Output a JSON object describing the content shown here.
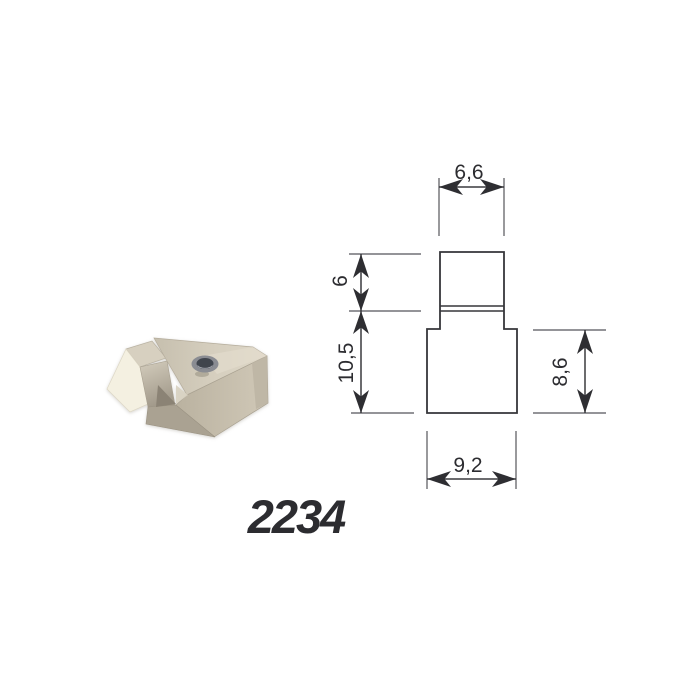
{
  "product": {
    "number": "2234"
  },
  "drawing": {
    "labels": {
      "top_width": "6,6",
      "upper_height": "6",
      "total_height": "10,5",
      "side_height": "8,6",
      "bottom_width": "9,2"
    },
    "line_color": "#3a3a3e",
    "label_color": "#2c2c30"
  },
  "part": {
    "colors": {
      "top_face": "#d3ccbb",
      "front_face": "#c7bfae",
      "end_face": "#bcb4a3",
      "chamfer_face": "#b9b1a1",
      "foot_face": "#aaa292",
      "notch_shadow": "#8b8374",
      "wedge_top": "#d7d0c0",
      "wedge_front": "#f4f0e1",
      "hole_rim": "#8a8c92",
      "hole_core": "#41444e"
    }
  },
  "background": "#ffffff"
}
